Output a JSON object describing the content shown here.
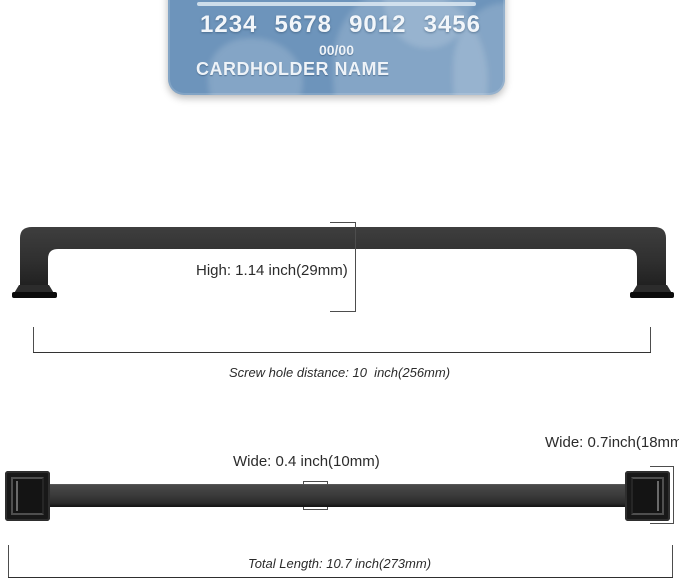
{
  "card": {
    "number_groups": [
      "1234",
      "5678",
      "9012",
      "3456"
    ],
    "expiry": "00/00",
    "cardholder": "CARDHOLDER NAME",
    "color": "#6d94bb"
  },
  "front_view": {
    "height_label": "High: 1.14 inch(29mm)",
    "screw_hole_label": "Screw hole distance: 10  inch(256mm)"
  },
  "top_view": {
    "bar_width_label": "Wide: 0.4 inch(10mm)",
    "end_width_label": "Wide: 0.7inch(18mm)",
    "total_length_label": "Total Length: 10.7 inch(273mm)"
  },
  "dimensions": {
    "height_inch": 1.14,
    "height_mm": 29,
    "screw_hole_distance_inch": 10,
    "screw_hole_distance_mm": 256,
    "bar_width_inch": 0.4,
    "bar_width_mm": 10,
    "end_width_inch": 0.7,
    "end_width_mm": 18,
    "total_length_inch": 10.7,
    "total_length_mm": 273
  },
  "colors": {
    "handle": "#2e2e2e",
    "card_blue": "#6d94bb",
    "dimension_line": "#4d4d4d",
    "background": "#ffffff"
  }
}
